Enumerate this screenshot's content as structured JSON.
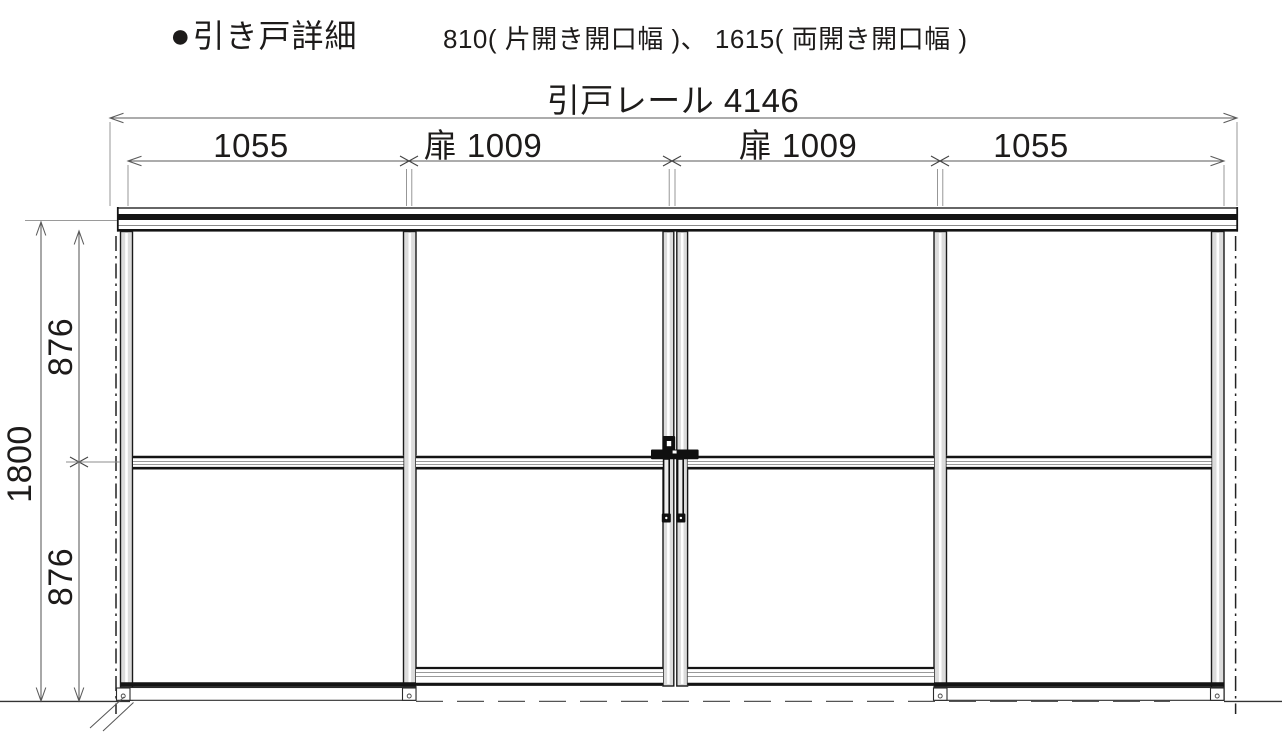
{
  "title": {
    "marker": "●",
    "heading": "引き戸詳細",
    "note": "810( 片開き開口幅 )、 1615( 両開き開口幅 )"
  },
  "dimensions": {
    "rail": "引戸レール 4146",
    "segments": [
      "1055",
      "扉 1009",
      "扉 1009",
      "1055"
    ],
    "height_total": "1800",
    "height_upper": "876",
    "height_lower": "876"
  },
  "colors": {
    "ink": "#1d1b1a",
    "frame_line": "#141414",
    "stile_fill": "#dcdcdc",
    "dim_line": "#5a5a5a",
    "background": "#ffffff"
  }
}
